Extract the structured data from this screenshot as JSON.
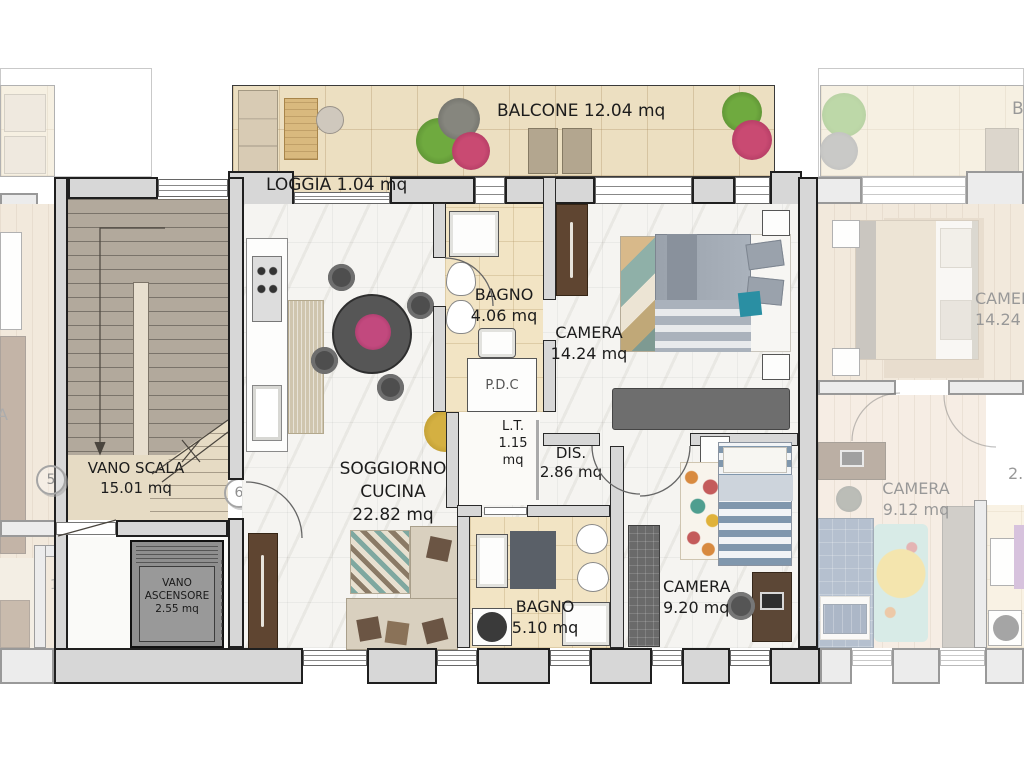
{
  "plan_title": "Apartment floor plan unit 6",
  "rooms": {
    "balcone": {
      "name": "BALCONE",
      "area": "12.04 mq"
    },
    "loggia": {
      "name": "LOGGIA",
      "area": "1.04 mq"
    },
    "bagno1": {
      "name": "BAGNO",
      "area": "4.06 mq"
    },
    "camera1": {
      "name": "CAMERA",
      "area": "14.24 mq"
    },
    "soggiorno": {
      "name": "SOGGIORNO CUCINA",
      "area": "22.82 mq"
    },
    "dis": {
      "name": "DIS.",
      "area": "2.86 mq"
    },
    "lt_main": {
      "name": "L.T.",
      "area_l1": "1.15",
      "area_l2": "mq"
    },
    "pdc_main": {
      "name": "P.D.C"
    },
    "bagno2": {
      "name": "BAGNO",
      "area": "5.10 mq"
    },
    "camera2": {
      "name": "CAMERA",
      "area": "9.20 mq"
    },
    "vano_scala": {
      "name": "VANO SCALA",
      "area": "15.01 mq"
    },
    "vano_ascensore": {
      "name_l1": "VANO",
      "name_l2": "ASCENSORE",
      "area": "2.55 mq"
    },
    "lt_left": {
      "name": "L.T.",
      "area": "1.76 mq"
    },
    "pdc_left": {
      "name": "P.D.C"
    },
    "camera_right_top": {
      "name": "CAMERA",
      "area": "14.24"
    },
    "camera_right_bottom": {
      "name": "CAMERA",
      "area": "9.12 mq"
    },
    "partial_right": "2.",
    "partial_left": "A",
    "partial_balcone_right": "B"
  },
  "markers": {
    "unit5": "5",
    "unit6": "6"
  },
  "colors": {
    "wall_fill": "#d7d7d7",
    "wall_line": "#1f1f1f",
    "balcony_floor": "#ecdfc1",
    "bath_floor": "#f2e4c4",
    "marble_floor": "#f5f4f1",
    "stair_floor": "#b2a99c",
    "wood_floor": "#e4d0b2",
    "elevator_fill": "#8f8f8f",
    "accent_teal": "#2a8fa3",
    "label_text": "#1c1c1c"
  }
}
